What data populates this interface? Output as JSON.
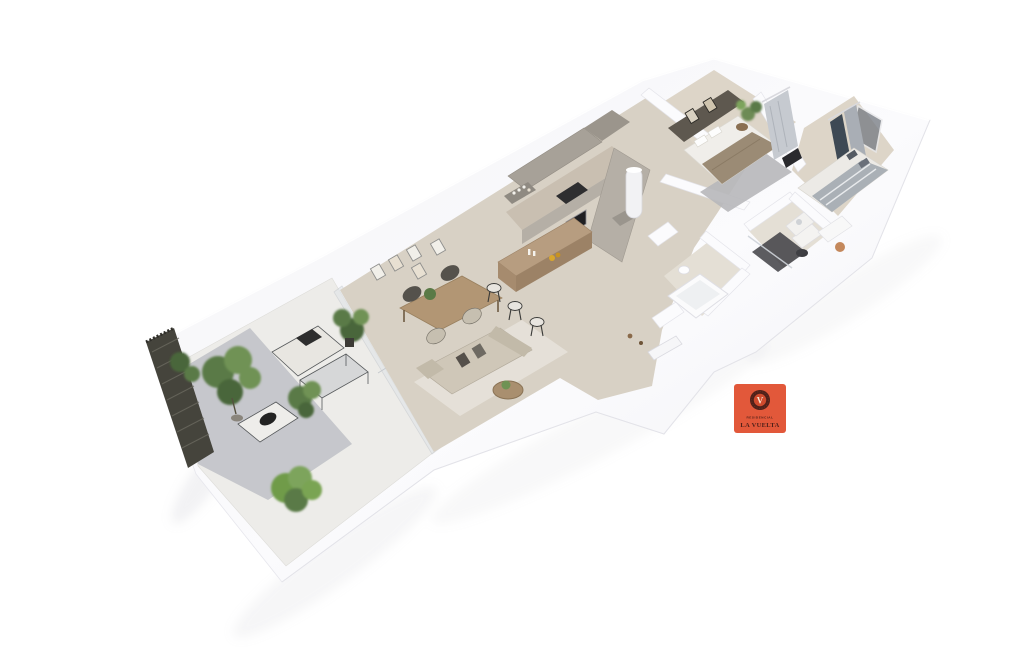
{
  "scene": {
    "background": "#ffffff",
    "type": "isometric-3d-floor-plan-render"
  },
  "rooms": [
    "terrace",
    "living-dining-room",
    "kitchen",
    "hallway",
    "bathroom",
    "shower-room",
    "main-bedroom",
    "second-bedroom"
  ],
  "palette": {
    "wall_white": "#f7f7fa",
    "wall_shade": "#ebebf0",
    "floor_tile": "#d8d1c5",
    "floor_wood": "#ddd5c8",
    "bath_floor": "#e4dfd5",
    "terrace_tile": "#edece9",
    "terrace_shade": "#b8bbc1",
    "louver_dark": "#45443c",
    "cabinet_taupe": "#a7a198",
    "counter_grey": "#b5afa6",
    "wood": "#b29674",
    "bar_wood": "#b79d80",
    "sofa_beige": "#cfc7b8",
    "cushion_dark": "#55504a",
    "bed_blanket": "#9b8b75",
    "rug_grey": "#b7b7ba",
    "rug_light": "#e8e3da",
    "curtain_dark": "#3e4954",
    "curtain_light": "#c6cad0",
    "accent_wall": "#5e584f",
    "plant_green": "#5a7a46",
    "plant_green_light": "#7da45c",
    "shadow": "#b9b9c0"
  },
  "logo": {
    "line1": "RESIDENCIAL",
    "line2": "LA VUELTA",
    "monogram": "V",
    "bg_color": "#e2583a",
    "emblem_ring_color": "#4f2019",
    "emblem_fill_color": "#cf4a2d",
    "monogram_color": "#f7e8d6",
    "text_color": "#4f2019"
  }
}
